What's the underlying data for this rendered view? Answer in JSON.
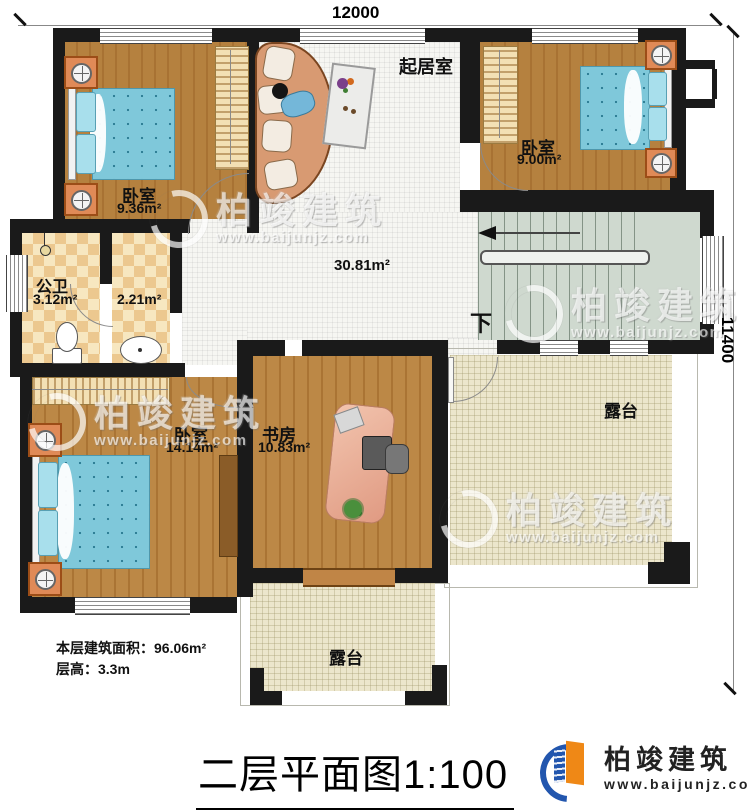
{
  "dimensions": {
    "top": "12000",
    "right": "11400"
  },
  "rooms": {
    "bedroom_top_left": {
      "name": "卧室",
      "area": "9.36m²"
    },
    "bedroom_top_right": {
      "name": "卧室",
      "area": "9.00m²"
    },
    "bedroom_bottom": {
      "name": "卧室",
      "area": "14.14m²"
    },
    "living": {
      "name": "起居室",
      "area": "30.81m²"
    },
    "bathroom": {
      "name": "公卫",
      "area": "3.12m²"
    },
    "antechamber": {
      "area": "2.21m²"
    },
    "study": {
      "name": "书房",
      "area": "10.83m²"
    },
    "terrace_right": {
      "name": "露台"
    },
    "terrace_bottom": {
      "name": "露台"
    },
    "stairs": {
      "down_label": "下"
    }
  },
  "info": {
    "floor_area": "本层建筑面积：96.06m²",
    "floor_height": "层高：3.3m"
  },
  "title": "二层平面图1:100",
  "logo": {
    "name": "柏竣建筑",
    "url": "www.baijunjz.com"
  },
  "watermark": {
    "name": "柏竣建筑",
    "url": "www.baijunjz.com"
  },
  "colors": {
    "wall": "#1a1a1a",
    "wood": "#b5813f",
    "bed": "#7fc8da",
    "terrace": "#ece6cc",
    "stairs": "#cfd9cf",
    "bath_tile": "#ecc88f",
    "furniture_orange": "#e08a57",
    "logo_blue": "#2256ae",
    "logo_orange": "#ef8816"
  }
}
